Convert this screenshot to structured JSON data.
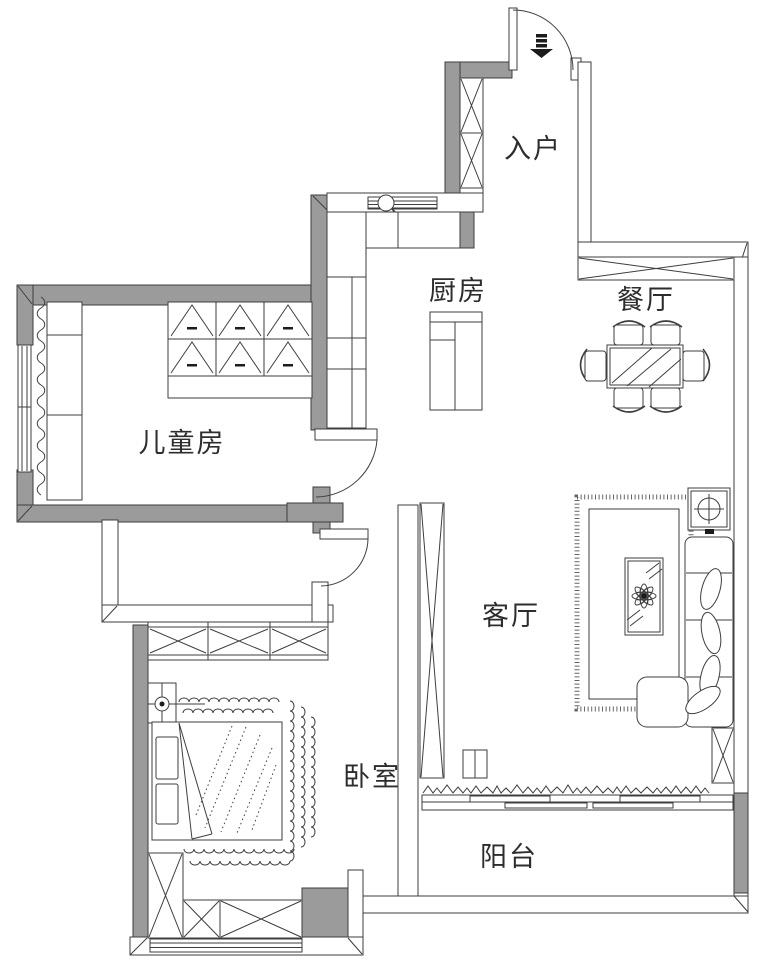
{
  "labels": {
    "entry": "入户",
    "kitchen": "厨房",
    "dining_room": "餐厅",
    "children_room": "儿童房",
    "living_room": "客厅",
    "bedroom": "卧室",
    "balcony": "阳台"
  },
  "colors": {
    "wall_fill": "#9b9b9b",
    "line": "#3e3e3e",
    "background": "#ffffff",
    "label_text": "#2d2d2d"
  },
  "icons": {
    "entry_direction": "down-arrow",
    "kitchen_sink": "faucet-circle",
    "living_lamp": "circle-crosshair",
    "bedroom_lamp": "circle-crosshair"
  }
}
